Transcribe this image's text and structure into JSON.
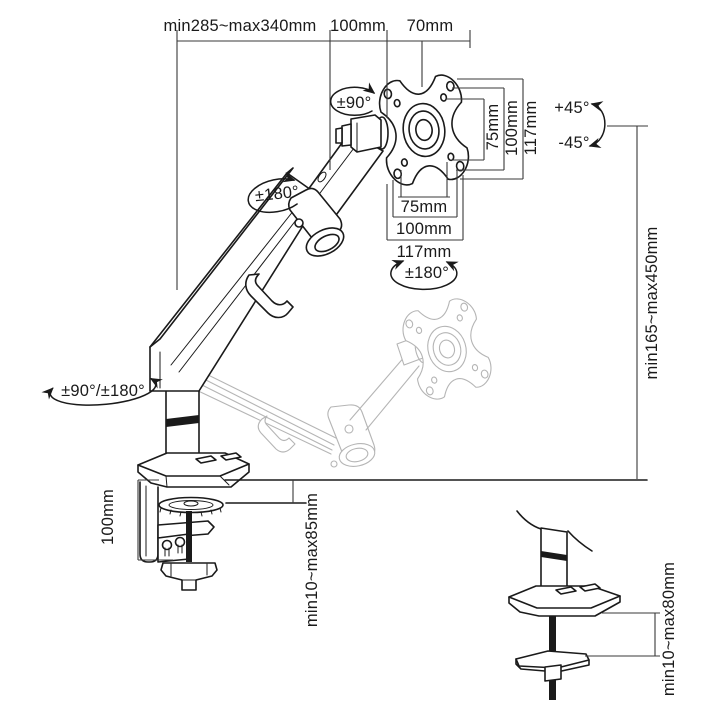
{
  "type": "technical-dimension-diagram",
  "subject": "gas-spring single monitor desk mount arm with C-clamp and grommet base",
  "colors": {
    "background": "#ffffff",
    "line": "#1a1a1a",
    "ghost_line": "#b5b5b5",
    "dimension_line": "#3a3a3a"
  },
  "labels": {
    "top_reach": "min285~max340mm",
    "top_joint_offset": "100mm",
    "top_vesa_depth": "70mm",
    "vesa_side_75": "75mm",
    "vesa_side_100": "100mm",
    "vesa_side_117": "117mm",
    "vesa_bottom_75": "75mm",
    "vesa_bottom_100": "100mm",
    "vesa_bottom_117": "117mm",
    "tilt_up": "+45°",
    "tilt_down": "-45°",
    "height_range": "min165~max450mm",
    "vesa_rotation": "±90°",
    "arm_swivel": "±180°",
    "head_swivel": "±180°",
    "base_swivel": "±90°/±180°",
    "clamp_column_height": "100mm",
    "clamp_thickness_range": "min10~max85mm",
    "grommet_thickness_range": "min10~max80mm"
  }
}
